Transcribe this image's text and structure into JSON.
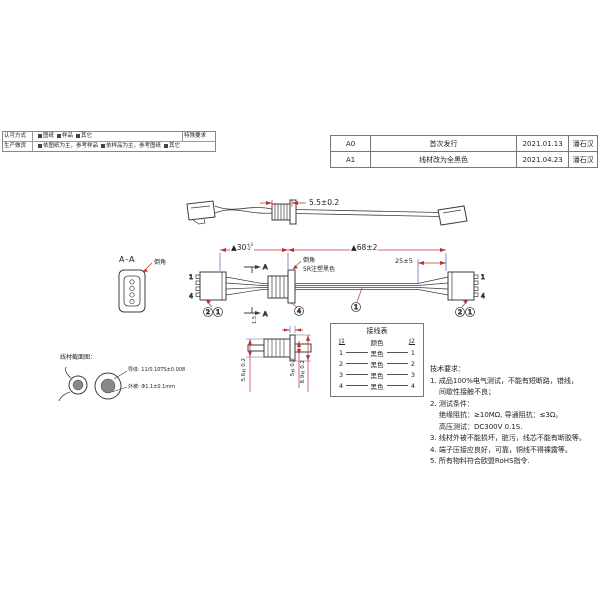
{
  "approval": {
    "row1_label": "认可方式",
    "row1_opt1": "图纸",
    "row1_opt2": "样品",
    "row1_opt3": "其它",
    "row1_extra": "特殊要求",
    "row2_label": "生产做货",
    "row2_opt1": "依图纸为主，参考样品",
    "row2_opt2": "依样品为主，参考图纸",
    "row2_opt3": "其它"
  },
  "revisions": {
    "rows": [
      {
        "rev": "A0",
        "desc": "首次发行",
        "date": "2021.01.13",
        "by": "潘石汉"
      },
      {
        "rev": "A1",
        "desc": "线材改为全黑色",
        "date": "2021.04.23",
        "by": "潘石汉"
      }
    ]
  },
  "overview": {
    "dim_grommet": "5.5±0.2"
  },
  "assembly": {
    "dim_left_main": "▲30",
    "dim_left_sup": "+3",
    "dim_left_sub": "-2",
    "dim_mid": "▲68±2",
    "dim_right": "25±5",
    "chamfer": "倒角",
    "mold": "5R注塑黑色",
    "section_top": "A",
    "section_bottom": "A",
    "pin_l_top": "1",
    "pin_l_bot": "4",
    "pin_r_top": "1",
    "pin_r_bot": "4",
    "balloon_l1": "2",
    "balloon_l2": "1",
    "balloon_grommet": "4",
    "balloon_wire": "1",
    "balloon_r1": "2",
    "balloon_r2": "1"
  },
  "section_view": {
    "title": "A-A",
    "chamfer": "倒角"
  },
  "detail": {
    "dim_top": "1.5",
    "dim_left": "5.6±0.2",
    "dim_mid": "5±0.2",
    "dim_right": "8.9±0.2"
  },
  "wiring": {
    "title": "接线表",
    "h_left": "J1",
    "h_mid": "颜色",
    "h_right": "J2",
    "rows": [
      {
        "l": "1",
        "c": "黑色",
        "r": "1"
      },
      {
        "l": "2",
        "c": "黑色",
        "r": "2"
      },
      {
        "l": "3",
        "c": "黑色",
        "r": "3"
      },
      {
        "l": "4",
        "c": "黑色",
        "r": "4"
      }
    ]
  },
  "tech": {
    "title": "技术要求：",
    "lines": [
      "1. 成品100%电气测试，不能有短断路，错线，",
      "间歇性接触不良；",
      "2. 测试条件：",
      "绝缘阻抗：≥10MΩ, 导通阻抗：≤3Ω。",
      "高压测试：DC300V 0.1S.",
      "3. 线材外被不能损坏，脏污，线芯不能有断胶等。",
      "4. 端子压接应良好，可靠，铜线不得裸露等。",
      "5. 所有物料符合欧盟RoHS指令."
    ]
  },
  "cross_section": {
    "title": "线材截面图：",
    "label_top": "导体: 11/0.10TS±0.008",
    "label_bottom": "外被: Φ1.1±0.1mm"
  },
  "colors": {
    "dim_red": "#c03030",
    "ext_blue": "#5560b8",
    "line": "#3c3c3c"
  }
}
